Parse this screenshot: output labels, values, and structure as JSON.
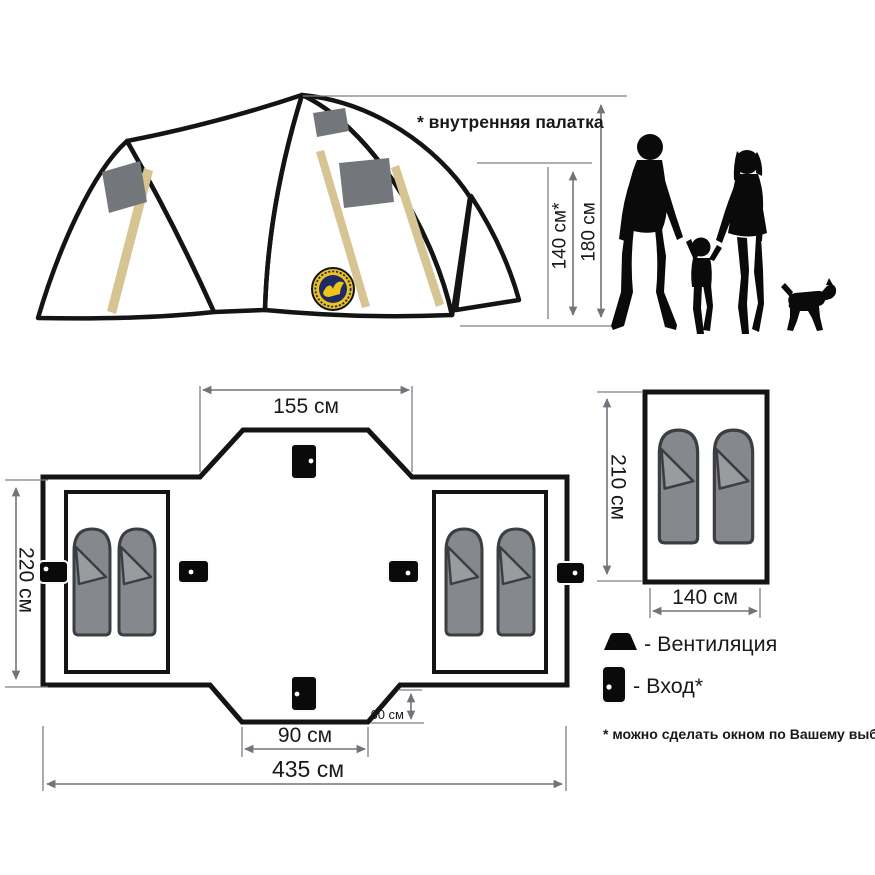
{
  "tent_view": {
    "annotation": "* внутренняя палатка",
    "inner_height": "140 см*",
    "outer_height": "180 см"
  },
  "floor_plan": {
    "top_width": "155 см",
    "depth": "220 см",
    "entrance_width": "90 см",
    "porch_depth": "60 см",
    "total_width": "435 см"
  },
  "inner_tent_view": {
    "length": "210 см",
    "width": "140 см"
  },
  "legend": {
    "ventilation": "- Вентиляция",
    "entrance": "- Вход*",
    "footnote": "* можно сделать окном по Вашему выбору"
  },
  "dimensions_cm": {
    "inner_height": 140,
    "outer_height": 180,
    "top_width": 155,
    "depth": 220,
    "entrance_width": 90,
    "porch_depth": 60,
    "total_width": 435,
    "inner_tent_length": 210,
    "inner_tent_width": 140
  },
  "icons": {
    "ventilation": "vent-trapezoid-icon",
    "entrance": "door-icon"
  },
  "colors": {
    "fabric_grey": "#9fa9b5",
    "fabric_tan": "#d6c493",
    "plan_grey": "#a5adb8",
    "window_grey": "#73777b",
    "bag_grey": "#85898d",
    "bag_flap_grey": "#989c9f",
    "inner_tent_white": "#ffffff",
    "outline": "#141414",
    "dimension_line": "#6f757b",
    "logo_navy": "#1e2a68",
    "logo_yellow": "#eec41b",
    "silhouette_black": "#0a0a0a"
  }
}
